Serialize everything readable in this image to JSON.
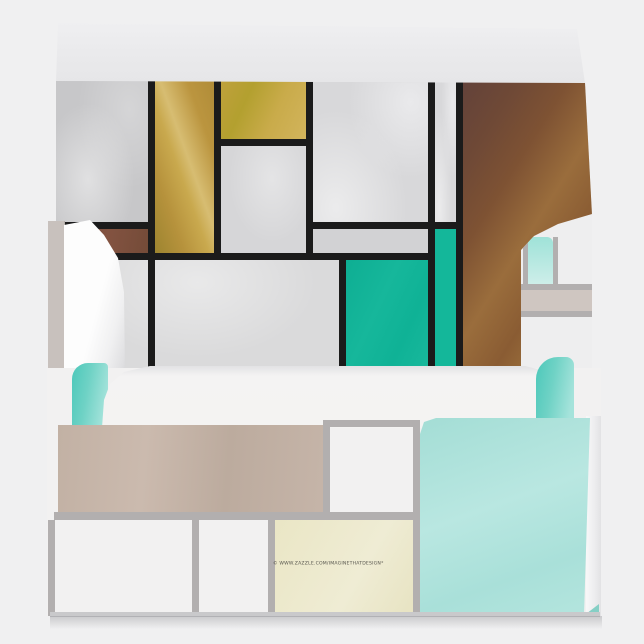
{
  "product_image": {
    "description": "Open envelope product mockup with Mondrian-style color-block liner and muted color-block exterior",
    "watermark_text": "© WWW.ZAZZLE.COM/IMAGINETHATDESIGN*",
    "palette": {
      "background": "#f0f0f1",
      "liner_line_black": "#1b1b1b",
      "liner_gray": "#d4d4d6",
      "gold": "#bb953f",
      "ochre": "#c2a43e",
      "brown": "#8a5c35",
      "dark_brown": "#6f4637",
      "teal": "#12b79a",
      "exterior_line_gray": "#b2afaf",
      "taupe": "#c2b1a4",
      "aqua": "#aadfd8",
      "bright_aqua": "#4ec7ba",
      "cream": "#ebe7c6",
      "paper_white": "#f4f3f2"
    }
  }
}
